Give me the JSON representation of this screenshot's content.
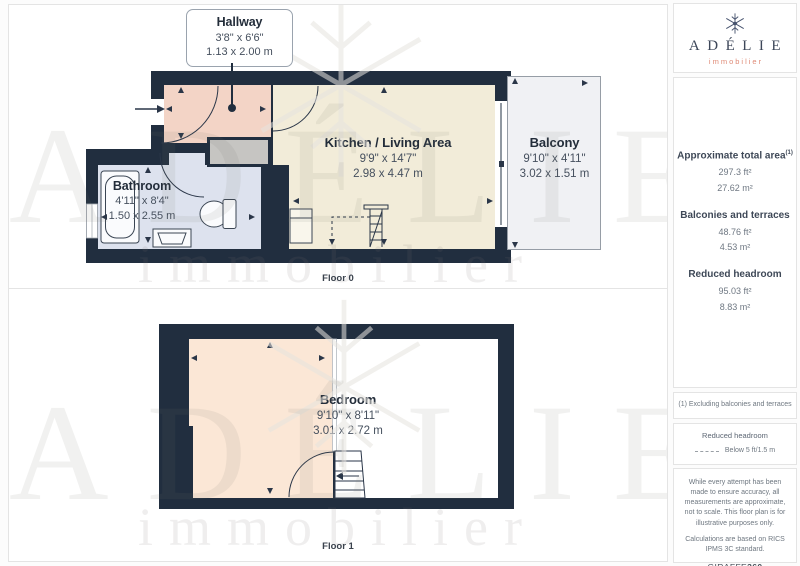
{
  "panel": {
    "floor0_label": "Floor 0",
    "floor1_label": "Floor 1"
  },
  "rooms": {
    "hallway": {
      "name": "Hallway",
      "imperial": "3'8\" x 6'6\"",
      "metric": "1.13 x 2.00 m"
    },
    "kitchen": {
      "name": "Kitchen / Living Area",
      "imperial": "9'9\" x 14'7\"",
      "metric": "2.98 x 4.47 m"
    },
    "balcony": {
      "name": "Balcony",
      "imperial": "9'10\" x 4'11\"",
      "metric": "3.02 x 1.51 m"
    },
    "bathroom": {
      "name": "Bathroom",
      "imperial": "4'11\" x 8'4\"",
      "metric": "1.50 x 2.55 m"
    },
    "bedroom": {
      "name": "Bedroom",
      "imperial": "9'10\" x 8'11\"",
      "metric": "3.01 x 2.72 m"
    }
  },
  "watermark": {
    "name": "ADÉLIE",
    "tagline": "immobilier"
  },
  "sidebar": {
    "brand": {
      "name": "ADÉLIE",
      "tagline": "immobilier"
    },
    "metrics": [
      {
        "label": "Approximate total area",
        "sup": "(1)",
        "ft": "297.3 ft²",
        "m": "27.62 m²"
      },
      {
        "label": "Balconies and terraces",
        "sup": "",
        "ft": "48.76 ft²",
        "m": "4.53 m²"
      },
      {
        "label": "Reduced headroom",
        "sup": "",
        "ft": "95.03 ft²",
        "m": "8.83 m²"
      }
    ],
    "note": "(1) Excluding balconies and terraces",
    "legend": {
      "title": "Reduced headroom",
      "item": "Below 5 ft/1.5 m"
    },
    "disclaimer_1": "While every attempt has been made to ensure accuracy, all measurements are approximate, not to scale. This floor plan is for illustrative purposes only.",
    "disclaimer_2": "Calculations are based on RICS IPMS 3C standard.",
    "credit": {
      "brand": "GIRAFFE",
      "suffix": "360"
    }
  },
  "colors": {
    "wall": "#212e3f",
    "hallway_floor": "#f3d4c6",
    "kitchen_floor": "#f2ecd9",
    "bathroom_floor": "#dde2ee",
    "bedroom_floor": "#fbe7d6",
    "closet": "#c6c5c2",
    "balcony_floor": "#f0f1f4",
    "accent_salmon": "#df8a76",
    "logo_navy": "#46526d"
  }
}
